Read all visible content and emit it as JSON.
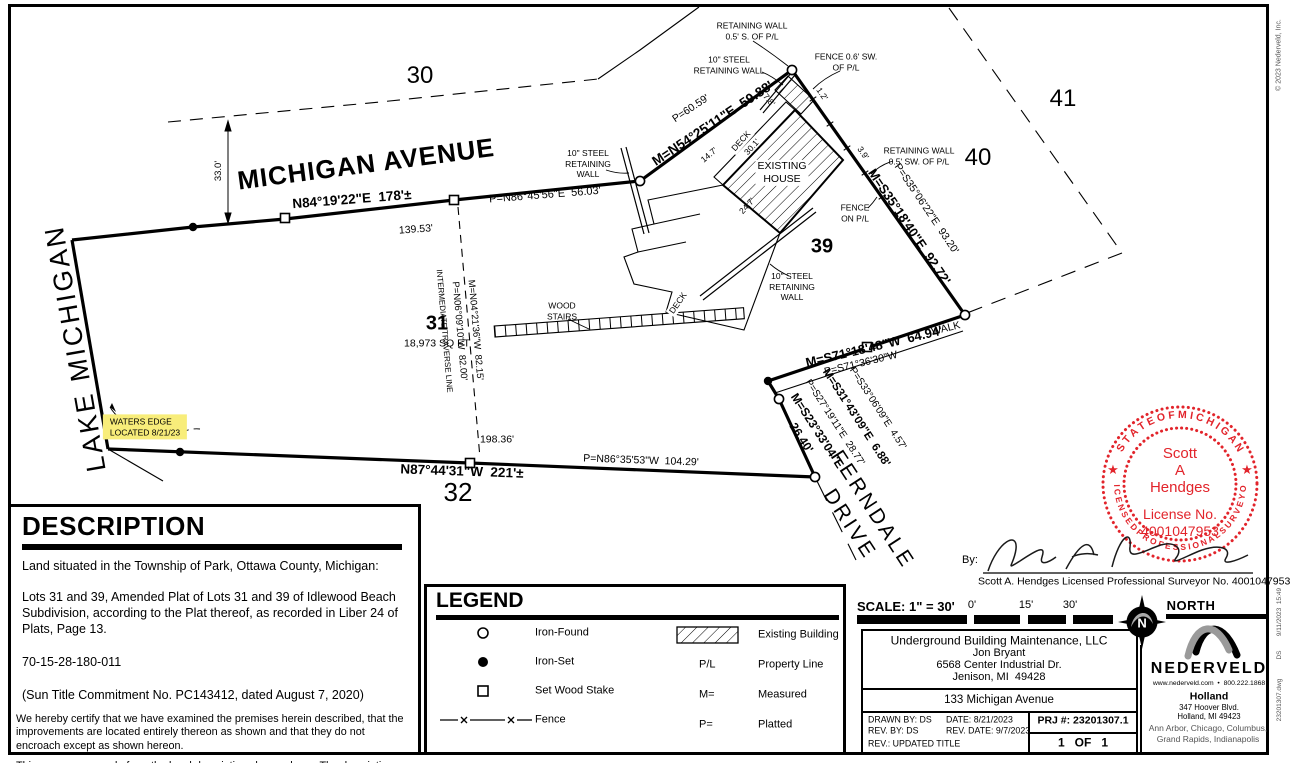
{
  "plat": {
    "streets": {
      "lake_michigan": "LAKE MICHIGAN",
      "michigan_avenue": "MICHIGAN AVENUE",
      "ferndale_drive": "FERNDALE\nDRIVE"
    },
    "lots": {
      "l30": "30",
      "l31": "31",
      "l31_area": "18,973 SQ FT",
      "l32": "32",
      "l39": "39",
      "l40": "40",
      "l41": "41"
    },
    "bearings": {
      "north_m": "N84°19'22\"E  178'±",
      "north_dim": "139.53'",
      "north_p": "P=N86°45'56\"E  56.03'",
      "ne_p": "P=60.59'",
      "ne_m": "M=N54°25'11\"E  59.88'",
      "east_p": "P=S35°06'22\"E  93.20'",
      "east_m": "M=S35°18'40\"E  92.72'",
      "walk_m": "M=S71°18'48\"W  64.94'",
      "walk_p": "P=S71°36'30\"W",
      "walk": "WALK",
      "fern1_m": "M=S23°33'04\"E",
      "fern1_dim": "26.40'",
      "fern1_p": "P=S27°19'11\"E  28.77'",
      "fern2_m": "M=S31°43'09\"E  6.88'",
      "fern2_p": "P=S33°06'09\"E  4.57'",
      "south_m": "N87°44'31\"W  221'±",
      "south_p": "P=N86°35'53\"W  104.29'",
      "south_dim": "198.36'",
      "traverse_label": "INTERMEDIATE TRAVERSE LINE",
      "traverse_p": "P=N06°09'10\"W  82.00'",
      "traverse_m": "M=N04°21'36\"W  82.15'",
      "row_width": "33.0'"
    },
    "callouts": {
      "rw_s": "RETAINING WALL\n0.5' S. OF P/L",
      "steel_top": "10\" STEEL\nRETAINING WALL",
      "fence_sw": "FENCE 0.6' SW.\nOF P/L",
      "steel_left": "10\" STEEL\nRETAINING\nWALL",
      "rw_sw": "RETAINING WALL\n0.5' SW. OF P/L",
      "fence_pl": "FENCE\nON P/L",
      "steel_low": "10\" STEEL\nRETAINING\nWALL",
      "wood_stairs": "WOOD\nSTAIRS",
      "waters_edge": "WATERS EDGE\nLOCATED 8/21/23",
      "existing_house": "EXISTING\nHOUSE",
      "deck": "DECK"
    },
    "dims": {
      "d147": "14.7'",
      "d78": "7.8'",
      "d301": "30.1'",
      "d247": "24.7'",
      "d12": "1.2'",
      "d39": "3.9'"
    }
  },
  "description": {
    "title": "DESCRIPTION",
    "p1": "Land situated in the Township of Park, Ottawa County, Michigan:",
    "p2": "Lots 31 and 39, Amended Plat of Lots 31 and 39 of Idlewood Beach Subdivision, according to the Plat thereof, as recorded in Liber 24 of Plats, Page 13.",
    "p3": "70-15-28-180-011",
    "p4": "(Sun Title Commitment No. PC143412, dated August 7, 2020)",
    "cert1": "We hereby certify that we have examined the premises herein described, that the improvements are located entirely thereon as shown and that they do not encroach except as shown hereon.",
    "cert2": "This survey was made from the legal description shown above.  The description should be compared with the Abstract of Title or Title Policy for accuracy, easements and exceptions."
  },
  "legend": {
    "title": "LEGEND",
    "iron_found": "Iron-Found",
    "iron_set": "Iron-Set",
    "set_wood_stake": "Set Wood Stake",
    "fence": "Fence",
    "existing_building": "Existing Building",
    "pl_sym": "P/L",
    "property_line": "Property Line",
    "m_sym": "M=",
    "measured": "Measured",
    "p_sym": "P=",
    "platted": "Platted"
  },
  "seal": {
    "arc_top": "S T A T E   O F   M I C H I G A N",
    "arc_bottom": "L I C E N S E D   P R O F E S S I O N A L   S U R V E Y O R",
    "star": "★",
    "name1": "Scott",
    "name2": "A",
    "name3": "Hendges",
    "lic1": "License No.",
    "lic2": "4001047953",
    "color": "#e2242b"
  },
  "signature": {
    "by": "By:",
    "line": "Scott A. Hendges Licensed Professional Surveyor No. 4001047953"
  },
  "scale_bar": {
    "label": "SCALE: 1\" = 30'",
    "t0": "0'",
    "t15": "15'",
    "t30": "30'"
  },
  "north": {
    "label": "NORTH",
    "n": "N"
  },
  "title_block": {
    "client": "Underground Building Maintenance, LLC",
    "contact": "Jon Bryant",
    "addr1": "6568 Center Industrial Dr.",
    "addr2": "Jenison, MI  49428",
    "site": "133 Michigan Avenue",
    "drawn_by": "DRAWN BY: DS",
    "date": "DATE: 8/21/2023",
    "rev_by": "REV. BY: DS",
    "rev_date": "REV. DATE: 9/7/2023",
    "rev": "REV.: UPDATED TITLE",
    "prj": "PRJ #: 23201307.1",
    "sheet": "1   OF   1"
  },
  "nederveld": {
    "name": "NEDERVELD",
    "web": "www.nederveld.com  •  800.222.1868",
    "office": "Holland",
    "addr1": "347 Hoover Blvd.",
    "addr2": "Holland, MI 49423",
    "cities": "Ann Arbor, Chicago, Columbus,\nGrand Rapids, Indianapolis"
  },
  "margin": {
    "copyright": "© 2023 Nederveld, Inc.",
    "stamp": "9/11/2023  15:49",
    "initials": "DS",
    "file": "23201307.dwg"
  }
}
